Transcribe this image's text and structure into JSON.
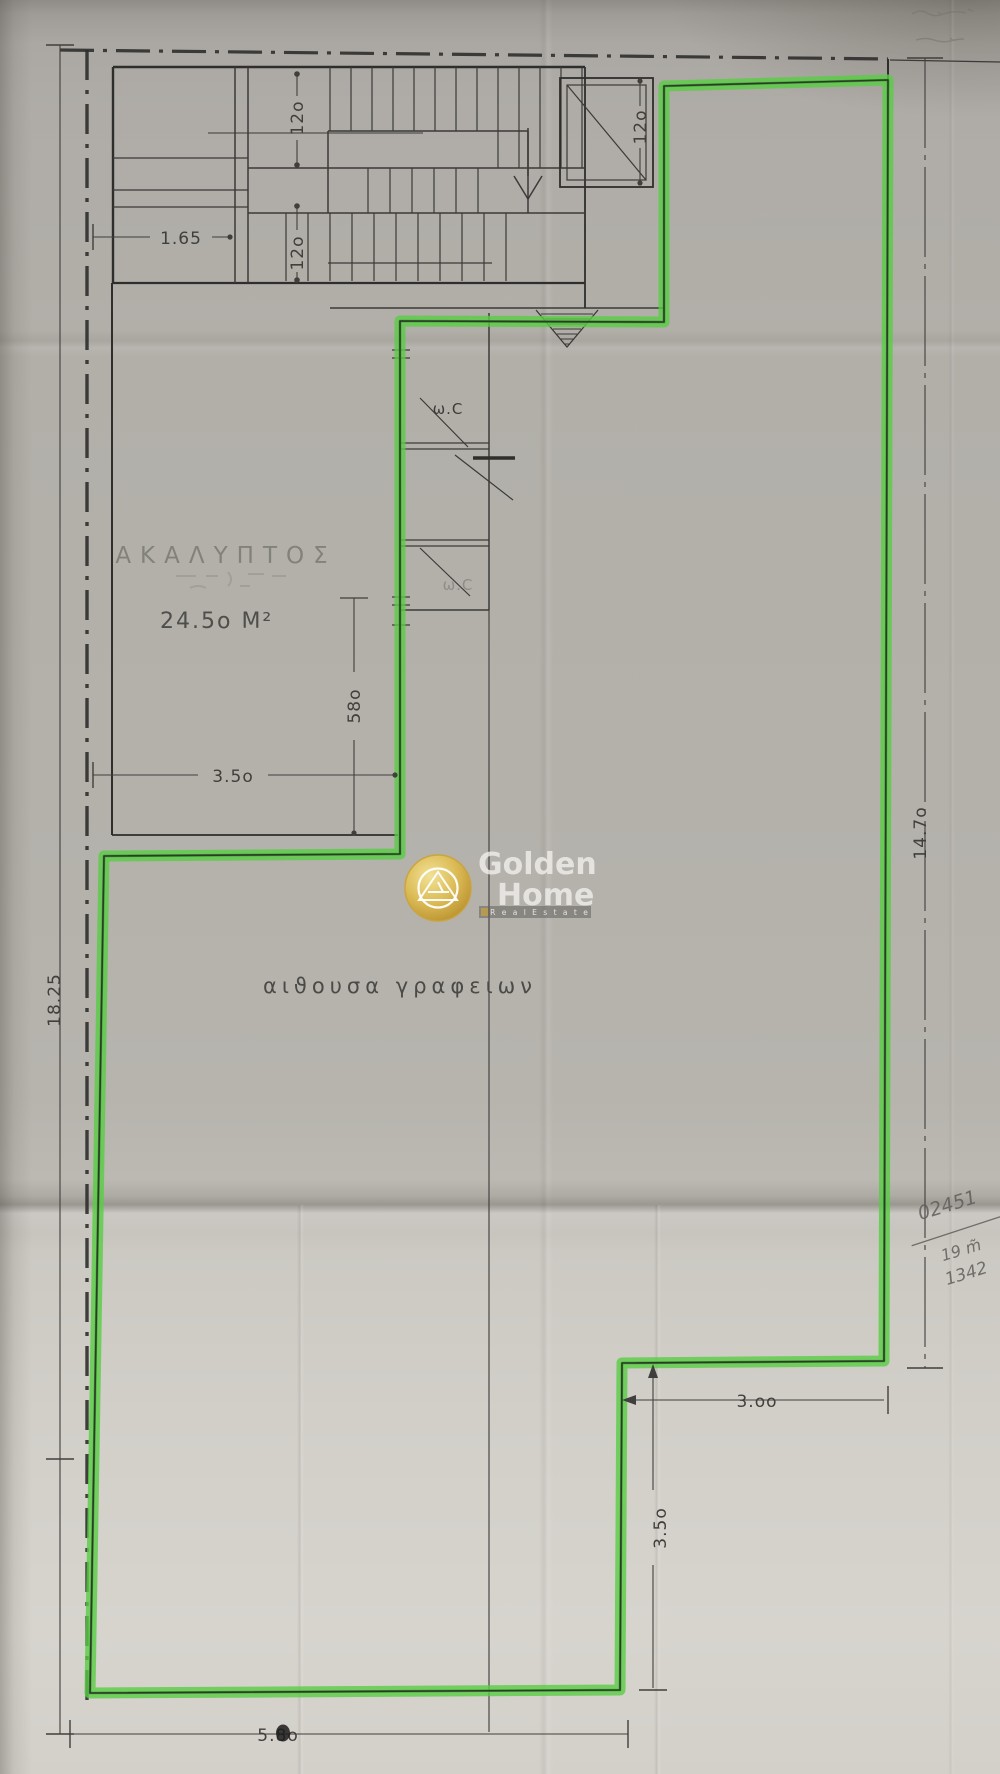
{
  "plan": {
    "rooms": {
      "courtyard": {
        "name": "ΑΚΑΛΥΠΤΟΣ",
        "area": "24.5ο Μ²"
      },
      "office_hall": {
        "name": "αιϑουσα  γραφειων"
      },
      "wc": {
        "label": "ω.C"
      }
    },
    "dims": {
      "left_total": "18.25",
      "right_total": "14.7ο",
      "stair_bay": "1.65",
      "flight_upper": "12ο",
      "flight_lower": "12ο",
      "elevator": "12ο",
      "courtyard_width": "3.5ο",
      "courtyard_edge": "58ο",
      "notch_width": "3.οο",
      "notch_depth": "3.5ο",
      "bottom_width": "5.8ο"
    }
  },
  "watermark": {
    "brand_line1": "Golden",
    "brand_line2": "Home",
    "tagline": "R e a l   E s t a t e"
  },
  "handwriting": {
    "note_top": "02451",
    "note_mid": "19 m̃",
    "note_bottom": "1342"
  },
  "colors": {
    "highlight_green": "#58cd43",
    "highlight_green_dark": "#2f9021",
    "ink": "#2e2e2c",
    "pencil": "#5f5e59",
    "paper_top": "#aeaba6",
    "paper_bottom": "#d5d2cd",
    "logo_gold": "#d4ab3c"
  }
}
